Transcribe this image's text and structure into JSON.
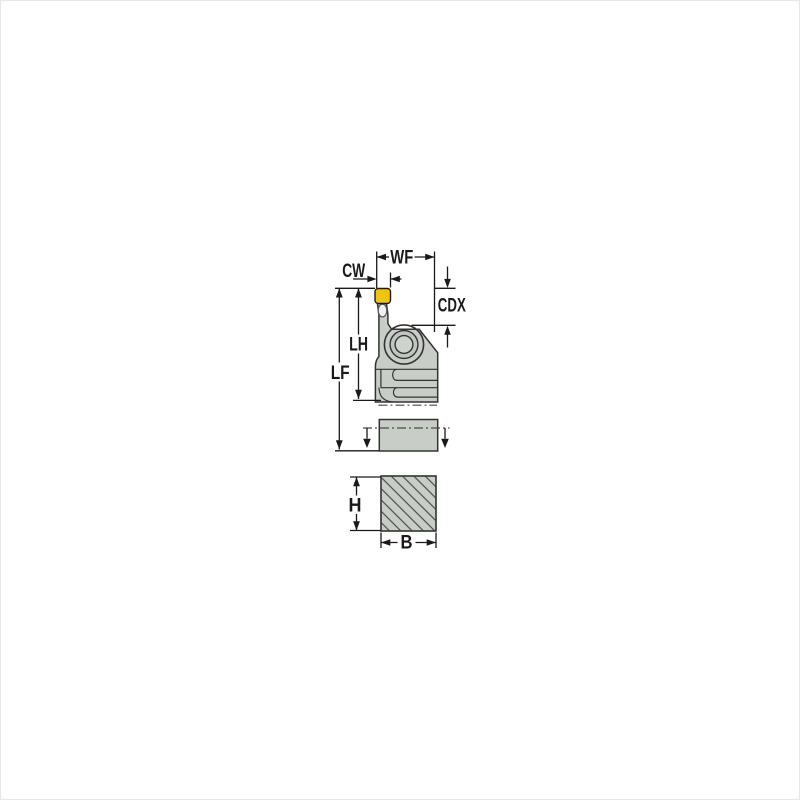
{
  "diagram": {
    "labels": {
      "wf": "WF",
      "cw": "CW",
      "cdx": "CDX",
      "lh": "LH",
      "lf": "LF",
      "h": "H",
      "b": "B"
    },
    "colors": {
      "background": "#ffffff",
      "frame": "#e8e8e8",
      "body_fill": "#c8cdc8",
      "body_fill_mid": "#c0c6c0",
      "body_fill_inner": "#ced3ce",
      "insert_fill": "#f2c412",
      "outline": "#333333",
      "dimension": "#1a1a1a",
      "hatch": "#4a4e4a"
    }
  }
}
